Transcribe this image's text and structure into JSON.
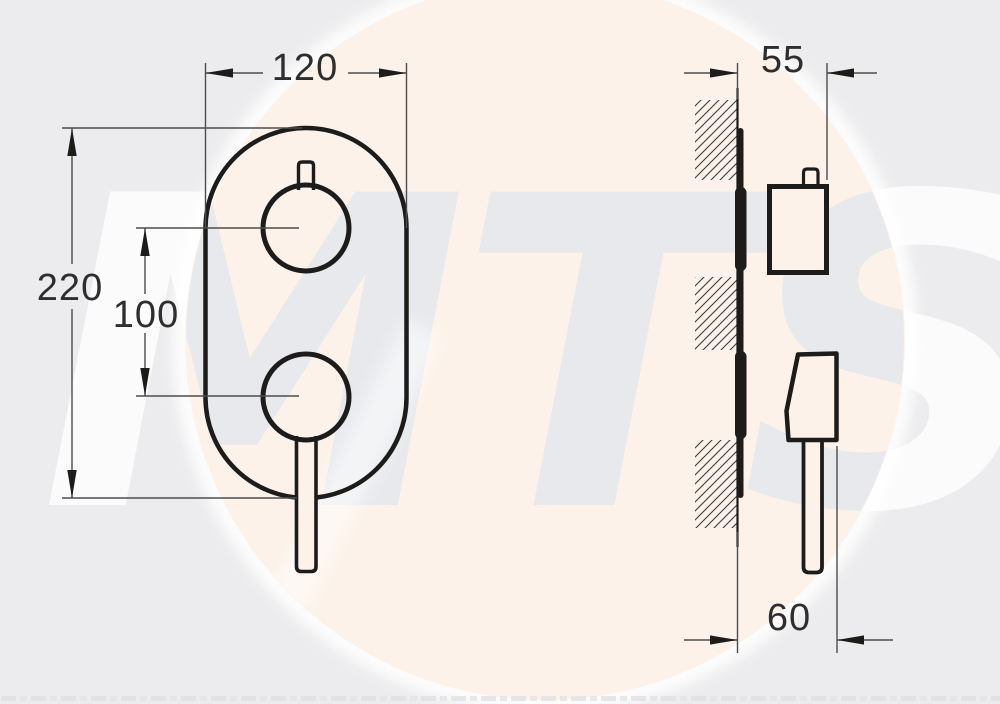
{
  "watermark": {
    "text": "MTS"
  },
  "front_view": {
    "dim_width": "120",
    "dim_height": "220",
    "dim_spacing": "100"
  },
  "side_view": {
    "dim_depth_top": "55",
    "dim_depth_bottom": "60"
  },
  "colors": {
    "background": "#ececee",
    "highlight_circle": "#fcf2e9",
    "object_line": "#1d1c1a",
    "dimension_line": "#4c4c4c",
    "dimension_text": "#2e2e2e",
    "watermark_on_circle": "#e7e9ed",
    "watermark_on_background": "#fdfdfe"
  }
}
